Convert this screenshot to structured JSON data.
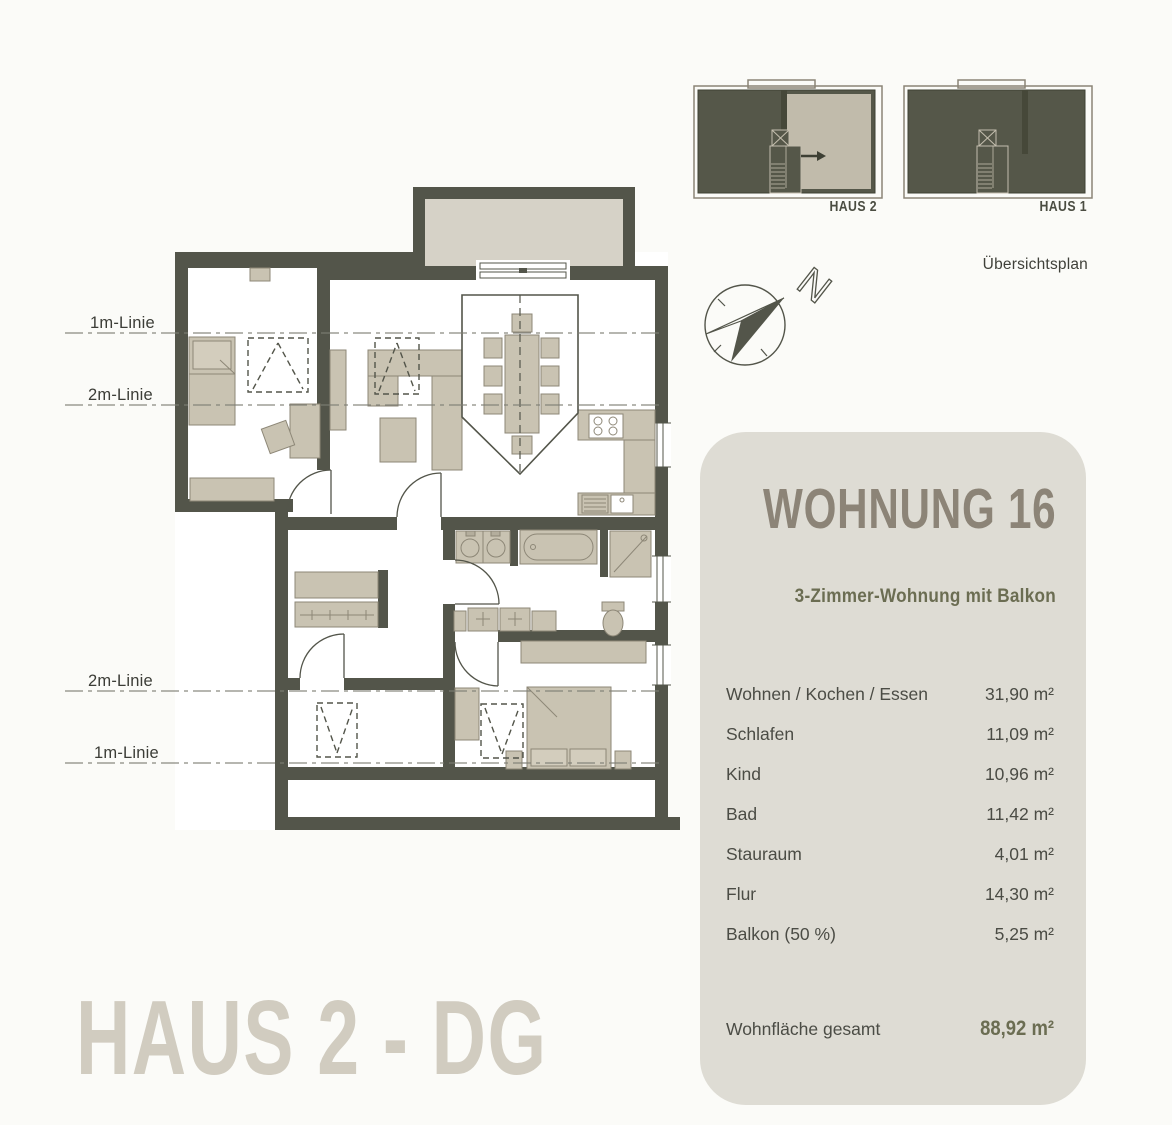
{
  "overview": {
    "haus2_label": "HAUS 2",
    "haus1_label": "HAUS 1",
    "caption": "Übersichtsplan"
  },
  "compass": {
    "north_label": "N"
  },
  "plan": {
    "height_lines": [
      {
        "label": "1m-Linie"
      },
      {
        "label": "2m-Linie"
      },
      {
        "label": "2m-Linie"
      },
      {
        "label": "1m-Linie"
      }
    ],
    "title": "HAUS 2 - DG"
  },
  "info_panel": {
    "title": "WOHNUNG 16",
    "subtitle": "3-Zimmer-Wohnung mit Balkon",
    "rooms": [
      {
        "name": "Wohnen / Kochen / Essen",
        "area": "31,90 m²"
      },
      {
        "name": "Schlafen",
        "area": "11,09 m²"
      },
      {
        "name": "Kind",
        "area": "10,96 m²"
      },
      {
        "name": "Bad",
        "area": "11,42 m²"
      },
      {
        "name": "Stauraum",
        "area": "4,01 m²"
      },
      {
        "name": "Flur",
        "area": "14,30 m²"
      },
      {
        "name": "Balkon (50 %)",
        "area": "5,25 m²"
      }
    ],
    "total_label": "Wohnfläche gesamt",
    "total_area": "88,92 m²"
  },
  "colors": {
    "wall": "#53554a",
    "furniture": "#c9c3b2",
    "balcony": "#d6d2c7",
    "panel_background": "#dedcd4",
    "accent_olive": "#6b6d52",
    "heading_gray": "#8c8477",
    "title_beige": "#d1ccc0",
    "highlight_unit": "#c1bbab"
  }
}
